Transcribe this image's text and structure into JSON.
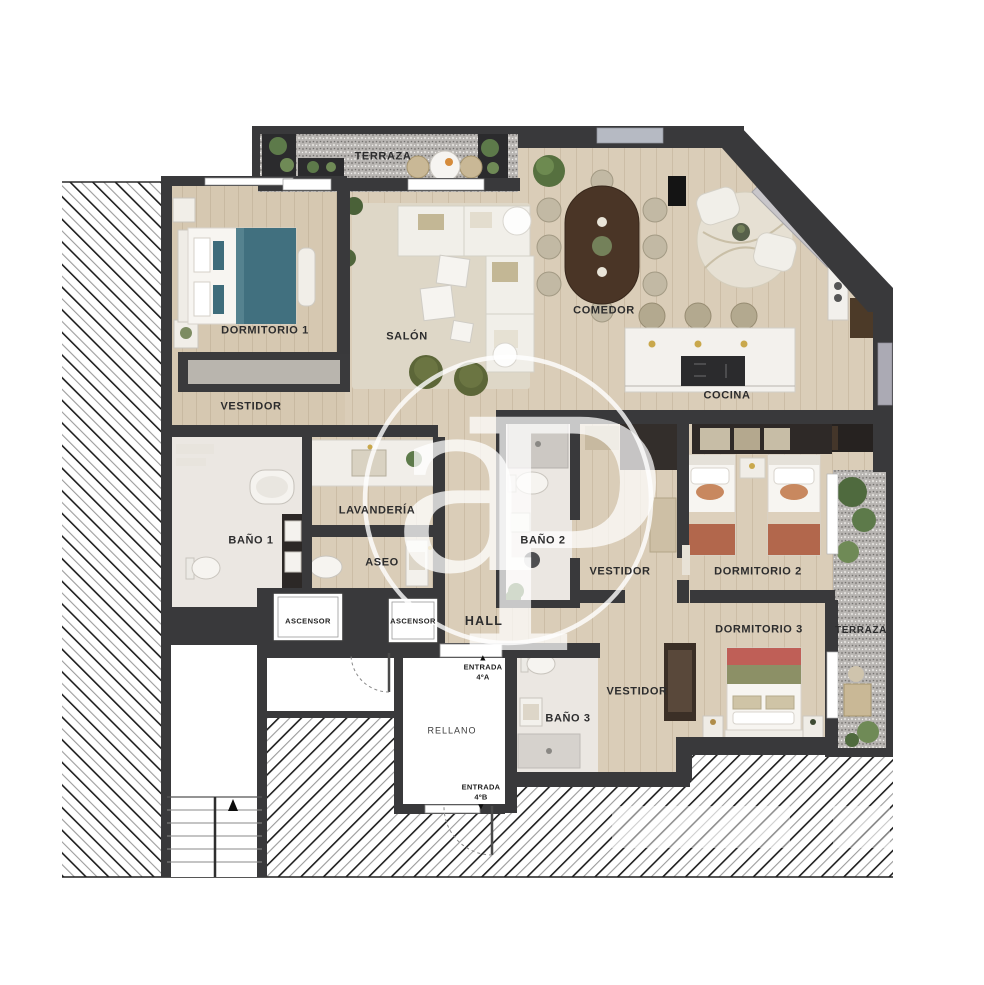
{
  "rooms": [
    {
      "id": "terraza-top",
      "label": "TERRAZA"
    },
    {
      "id": "dormitorio-1",
      "label": "DORMITORIO 1"
    },
    {
      "id": "salon",
      "label": "SALÓN"
    },
    {
      "id": "comedor",
      "label": "COMEDOR"
    },
    {
      "id": "cocina",
      "label": "COCINA"
    },
    {
      "id": "vestidor-1",
      "label": "VESTIDOR"
    },
    {
      "id": "bano-1",
      "label": "BAÑO 1"
    },
    {
      "id": "lavanderia",
      "label": "LAVANDERÍA"
    },
    {
      "id": "aseo",
      "label": "ASEO"
    },
    {
      "id": "bano-2",
      "label": "BAÑO 2"
    },
    {
      "id": "vestidor-2",
      "label": "VESTIDOR"
    },
    {
      "id": "dormitorio-2",
      "label": "DORMITORIO 2"
    },
    {
      "id": "dormitorio-3",
      "label": "DORMITORIO 3"
    },
    {
      "id": "terraza-right",
      "label": "TERRAZA"
    },
    {
      "id": "vestidor-3",
      "label": "VESTIDOR"
    },
    {
      "id": "bano-3",
      "label": "BAÑO 3"
    },
    {
      "id": "hall",
      "label": "HALL"
    }
  ],
  "common": {
    "ascensor_1": "ASCENSOR",
    "ascensor_2": "ASCENSOR",
    "rellano": "RELLANO",
    "entrada_a_line1": "ENTRADA",
    "entrada_a_line2": "4ºA",
    "entrada_b_line1": "ENTRADA",
    "entrada_b_line2": "4ºB",
    "arrow_up": "▲",
    "arrow_down": "▼"
  },
  "watermark": {
    "letter_a": "a",
    "letter_p": "P"
  },
  "colors": {
    "wall": "#39393b",
    "wood_floor": "#dacdb8",
    "marble_floor": "#ebe7e2",
    "gravel": "#b8b5b2",
    "bed_teal": "#41707f",
    "bed_terracotta": "#b2674c",
    "bed_red": "#bf5f57",
    "bed_green": "#8c9066",
    "pouf_olive": "#5c6638",
    "dining_table": "#4a3526",
    "rug": "#ded7c7",
    "accent_gold": "#c9a84c"
  }
}
